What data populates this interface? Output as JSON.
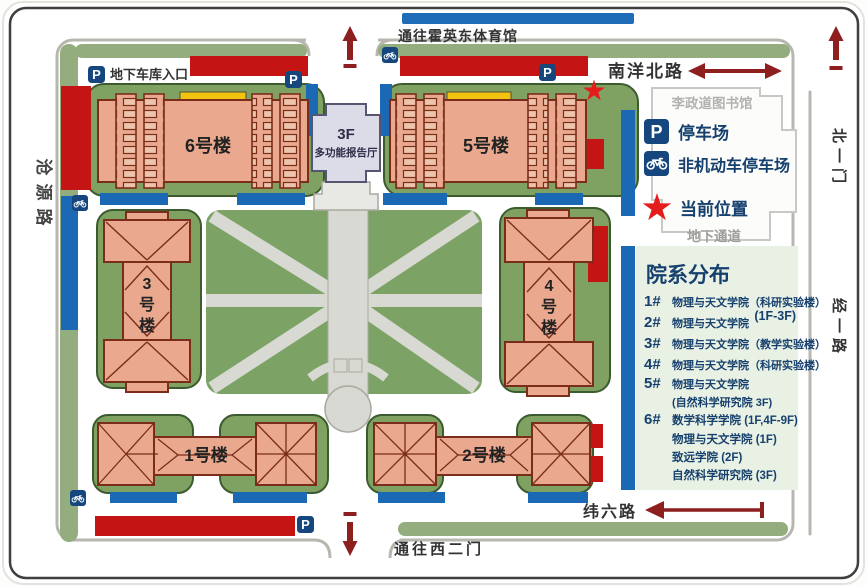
{
  "roads": {
    "to_gym": "通往霍英东体育馆",
    "nanyang_north": "南洋北路",
    "north_gate": "北一门",
    "jingyi_road": "经一路",
    "cangyuan_road": "沧源路",
    "weiliu_road": "纬六路",
    "to_west_gate": "通往西二门"
  },
  "buildings": {
    "b1": "1号楼",
    "b2": "2号楼",
    "b3_chars": [
      "3",
      "号",
      "楼"
    ],
    "b4_chars": [
      "4",
      "号",
      "楼"
    ],
    "b5": "5号楼",
    "b6": "6号楼",
    "hall_floor": "3F",
    "hall_name": "多功能报告厅",
    "library": "李政道图书馆"
  },
  "legend": {
    "p_glyph": "P",
    "parking": "停车场",
    "bike_parking": "非机动车停车场",
    "current_location": "当前位置",
    "underpass": "地下通道",
    "garage_entrance": "地下车库入口"
  },
  "panel": {
    "title": "院系分布",
    "rows": [
      {
        "num": "1#",
        "text": "物理与天文学院（科研实验楼）"
      },
      {
        "num": "",
        "text": "(1F-3F)"
      },
      {
        "num": "2#",
        "text": "物理与天文学院"
      },
      {
        "num": "3#",
        "text": "物理与天文学院（教学实验楼）"
      },
      {
        "num": "4#",
        "text": "物理与天文学院（科研实验楼）"
      },
      {
        "num": "5#",
        "text": "物理与天文学院"
      },
      {
        "num": "",
        "text": "(自然科学研究院 3F)"
      },
      {
        "num": "6#",
        "text": "数学科学学院 (1F,4F-9F)"
      },
      {
        "num": "",
        "text": "物理与天文学院 (1F)"
      },
      {
        "num": "",
        "text": "致远学院 (2F)"
      },
      {
        "num": "",
        "text": "自然科学研究院 (3F)"
      }
    ]
  },
  "colors": {
    "parking_red": "#c51414",
    "bike_blue": "#1b69b4",
    "navy": "#16406e",
    "building_salmon": "#eaa98e",
    "pad_green": "#7fa161",
    "star_red": "#e51c1c",
    "arrow_dark_red": "#8e1f1f",
    "hall_lavender": "#dcdce8",
    "highlight_yellow": "#f2c40f"
  }
}
